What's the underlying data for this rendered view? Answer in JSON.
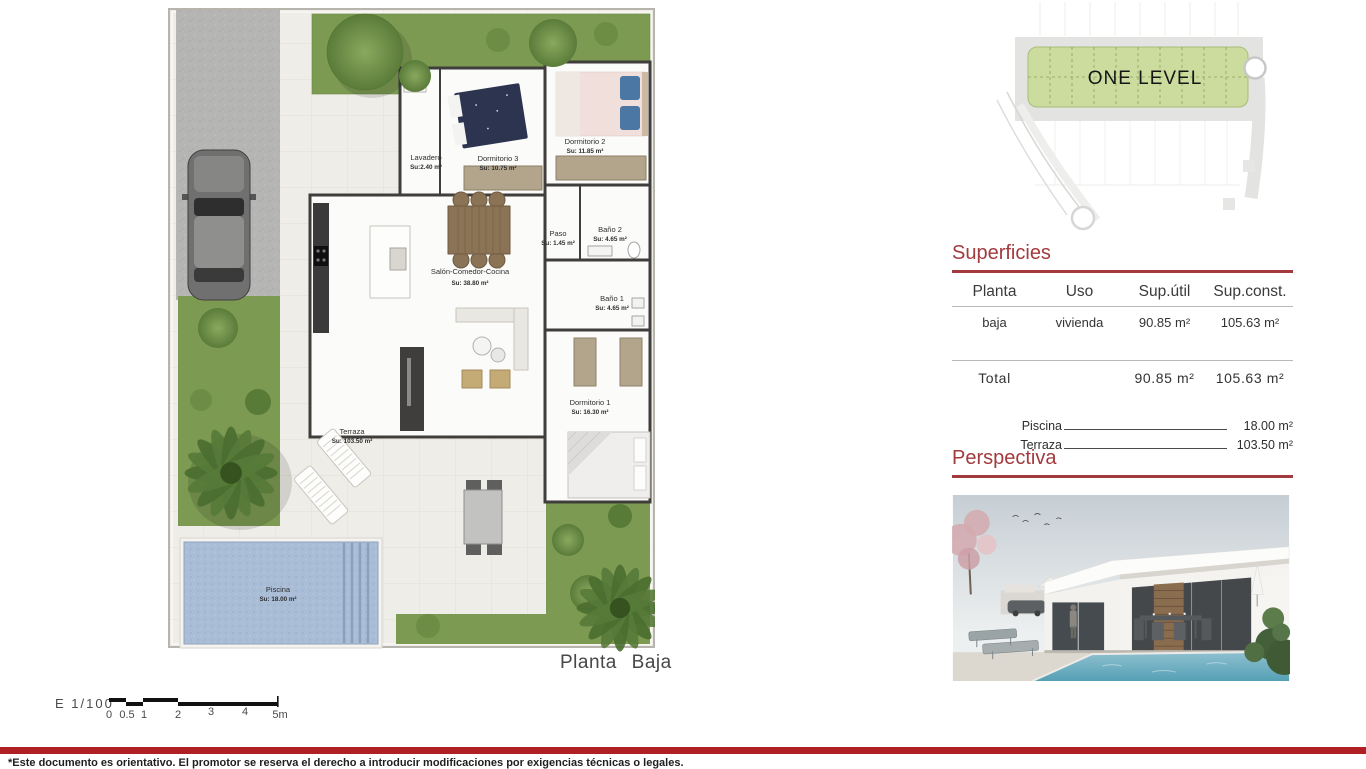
{
  "document": {
    "plan_title": "Planta Baja",
    "footer_note": "*Este documento es orientativo. El promotor se reserva el derecho a introducir modificaciones por exigencias técnicas o legales."
  },
  "scale_bar": {
    "label": "E 1/100",
    "ticks": [
      "0",
      "0.5",
      "1",
      "2",
      "3",
      "4",
      "5m"
    ]
  },
  "site_plan": {
    "label": "ONE LEVEL"
  },
  "floor_plan": {
    "rooms": [
      {
        "name": "Lavadero",
        "area": "Su:2.40 m²"
      },
      {
        "name": "Dormitorio 3",
        "area": "Su: 10.75 m²"
      },
      {
        "name": "Dormitorio 2",
        "area": "Su: 11.85 m²"
      },
      {
        "name": "Paso",
        "area": "Su: 1.45 m²"
      },
      {
        "name": "Baño 2",
        "area": "Su: 4.65 m²"
      },
      {
        "name": "Baño 1",
        "area": "Su: 4.65 m²"
      },
      {
        "name": "Salón-Comedor-Cocina",
        "area": "Su: 38.80 m²"
      },
      {
        "name": "Dormitorio 1",
        "area": "Su: 16.30 m²"
      },
      {
        "name": "Terraza",
        "area": "Su: 103.50 m²"
      },
      {
        "name": "Piscina",
        "area": "Su: 18.00 m²"
      }
    ]
  },
  "superficies": {
    "title": "Superficies",
    "columns": [
      "Planta",
      "Uso",
      "Sup.útil",
      "Sup.const."
    ],
    "row": {
      "planta": "baja",
      "uso": "vivienda",
      "sup_util": "90.85 m²",
      "sup_const": "105.63 m²"
    },
    "total": {
      "label": "Total",
      "sup_util": "90.85 m²",
      "sup_const": "105.63 m²"
    },
    "extras": [
      {
        "label": "Piscina",
        "value": "18.00 m²"
      },
      {
        "label": "Terraza",
        "value": "103.50 m²"
      }
    ]
  },
  "perspectiva": {
    "title": "Perspectiva"
  },
  "colors": {
    "accent_red": "#a23a3e",
    "footer_bar_red": "#b01f24",
    "grass_green": "#7c9a51",
    "site_plan_green": "#ccdc9e",
    "pool_blue": "#a9bdd6"
  }
}
